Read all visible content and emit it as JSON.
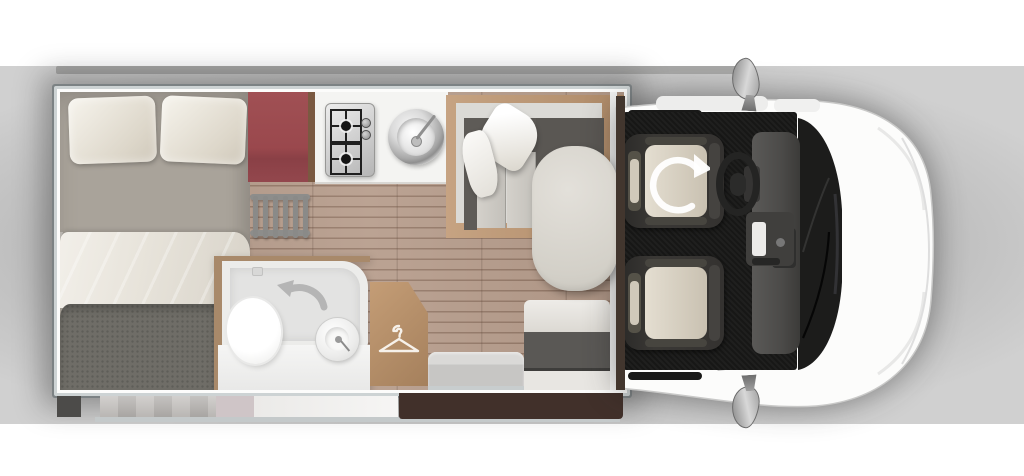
{
  "app": {
    "title": "Campervan floor plan, top view"
  },
  "icons": {
    "snowflake": "snowflake-icon (fridge/freezer)",
    "hanger": "clothes-hanger-icon (wardrobe)",
    "undo_arrow": "swivel-arrow-icon (bathroom folding wall)",
    "swivel_arrow": "swivel-arrow-icon (rotating cab seat)"
  },
  "colors": {
    "fridge_red": "#9a484d",
    "wood_floor": "#b69c8b",
    "wood_furniture": "#b08a64",
    "charcoal_upholstery": "#5e5b57",
    "seat_beige": "#d5cec0",
    "cab_floor_black": "#171716",
    "skirt_brown": "#41302a",
    "silver_trim": "#cdd3d4",
    "body_white": "#fcfcfb"
  },
  "areas": {
    "bedroom": {
      "label": "Double bed with pillows and duvet"
    },
    "fridge": {
      "label": "Fridge / freezer with snowflake icon"
    },
    "kitchen": {
      "label": "Kitchen worktop with 2-burner hob and round sink"
    },
    "ladder": {
      "label": "Bunk ladder"
    },
    "dinette": {
      "label": "L-shaped lounge seating with cushions"
    },
    "table": {
      "label": "Dining table"
    },
    "bathroom": {
      "label": "Bathroom with toilet, washbasin and shower tray"
    },
    "wardrobe": {
      "label": "Wardrobe with hanger icon"
    },
    "bench": {
      "label": "Forward-facing travel bench"
    },
    "cab": {
      "label": "Driver cab with two swivel seats, steering wheel and mirrors"
    },
    "front": {
      "label": "Vehicle front with windscreen, bonnet and bumper"
    }
  }
}
